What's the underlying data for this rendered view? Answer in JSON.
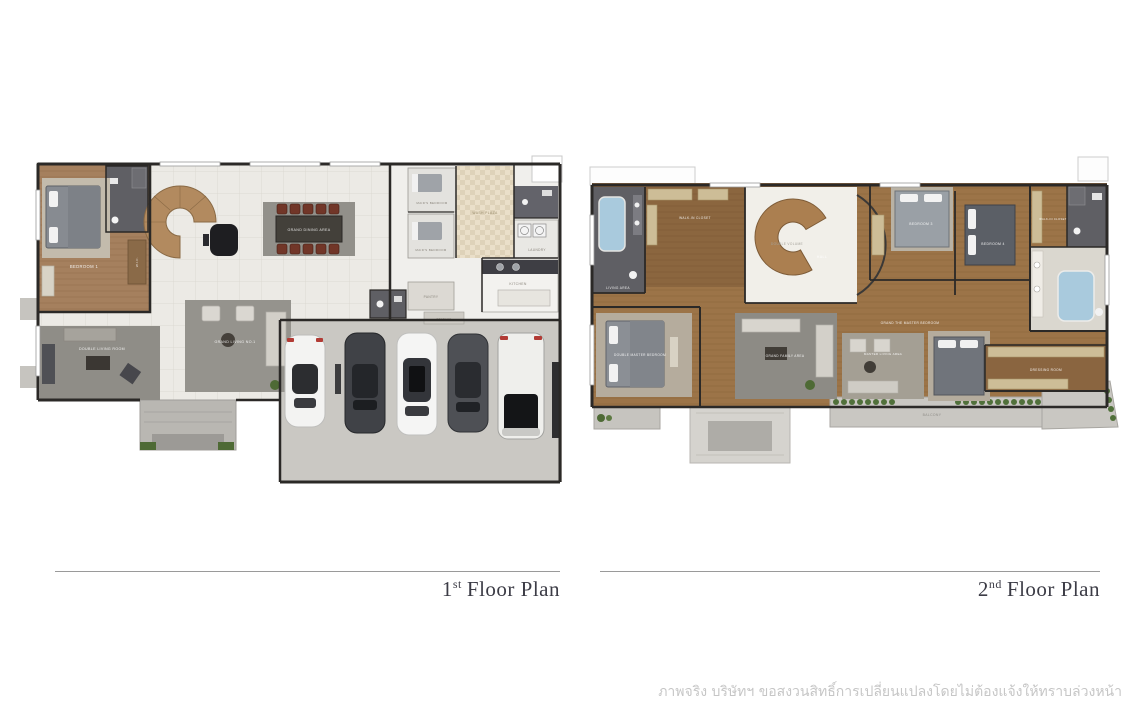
{
  "floor_plans": [
    {
      "id": "first-floor",
      "title_number": "1",
      "title_ordinal": "st",
      "title_text": "Floor Plan",
      "rooms": {
        "bedroom1": "BEDROOM 1",
        "wic": "W.I.C.",
        "dining": "GRAND DINING AREA",
        "living": "GRAND LIVING NO.1",
        "double_living": "DOUBLE LIVING ROOM",
        "maid1": "MAID'S BEDROOM",
        "maid2": "MAID'S BEDROOM",
        "wash_plaza": "WASH PLAZA",
        "laundry": "LAUNDRY",
        "kitchen": "KITCHEN",
        "pantry": "PANTRY",
        "storage": "STORAGE"
      }
    },
    {
      "id": "second-floor",
      "title_number": "2",
      "title_ordinal": "nd",
      "title_text": "Floor Plan",
      "rooms": {
        "walk_in_closet": "WALK-IN CLOSET",
        "double_volume": "DOUBLE VOLUME",
        "hall": "HALL",
        "living_area": "LIVING AREA",
        "double_master": "DOUBLE MASTER BEDROOM",
        "family": "GRAND FAMILY AREA",
        "master_corridor": "GRAND THE MASTER BEDROOM",
        "master_living": "MASTER LIVING AREA",
        "bedroom3": "BEDROOM 3",
        "bedroom4": "BEDROOM 4",
        "wic2": "WALK-IN CLOSET",
        "dressing": "DRESSING ROOM",
        "balcony": "BALCONY"
      }
    }
  ],
  "disclaimer": "ภาพจริง บริษัทฯ ขอสงวนสิทธิ์การเปลี่ยนแปลงโดยไม่ต้องแจ้งให้ทราบล่วงหน้า",
  "colors": {
    "title": "#3c3c46",
    "disclaimer": "#c6c6c6",
    "wood_floor": "#9c7448",
    "tile_floor": "#eceae5",
    "bathroom_tile": "#5f5f64",
    "garage_concrete": "#cac8c3",
    "bathtub": "#a9cadd",
    "plants": "#4e6a35",
    "walls": "#2b2927"
  }
}
